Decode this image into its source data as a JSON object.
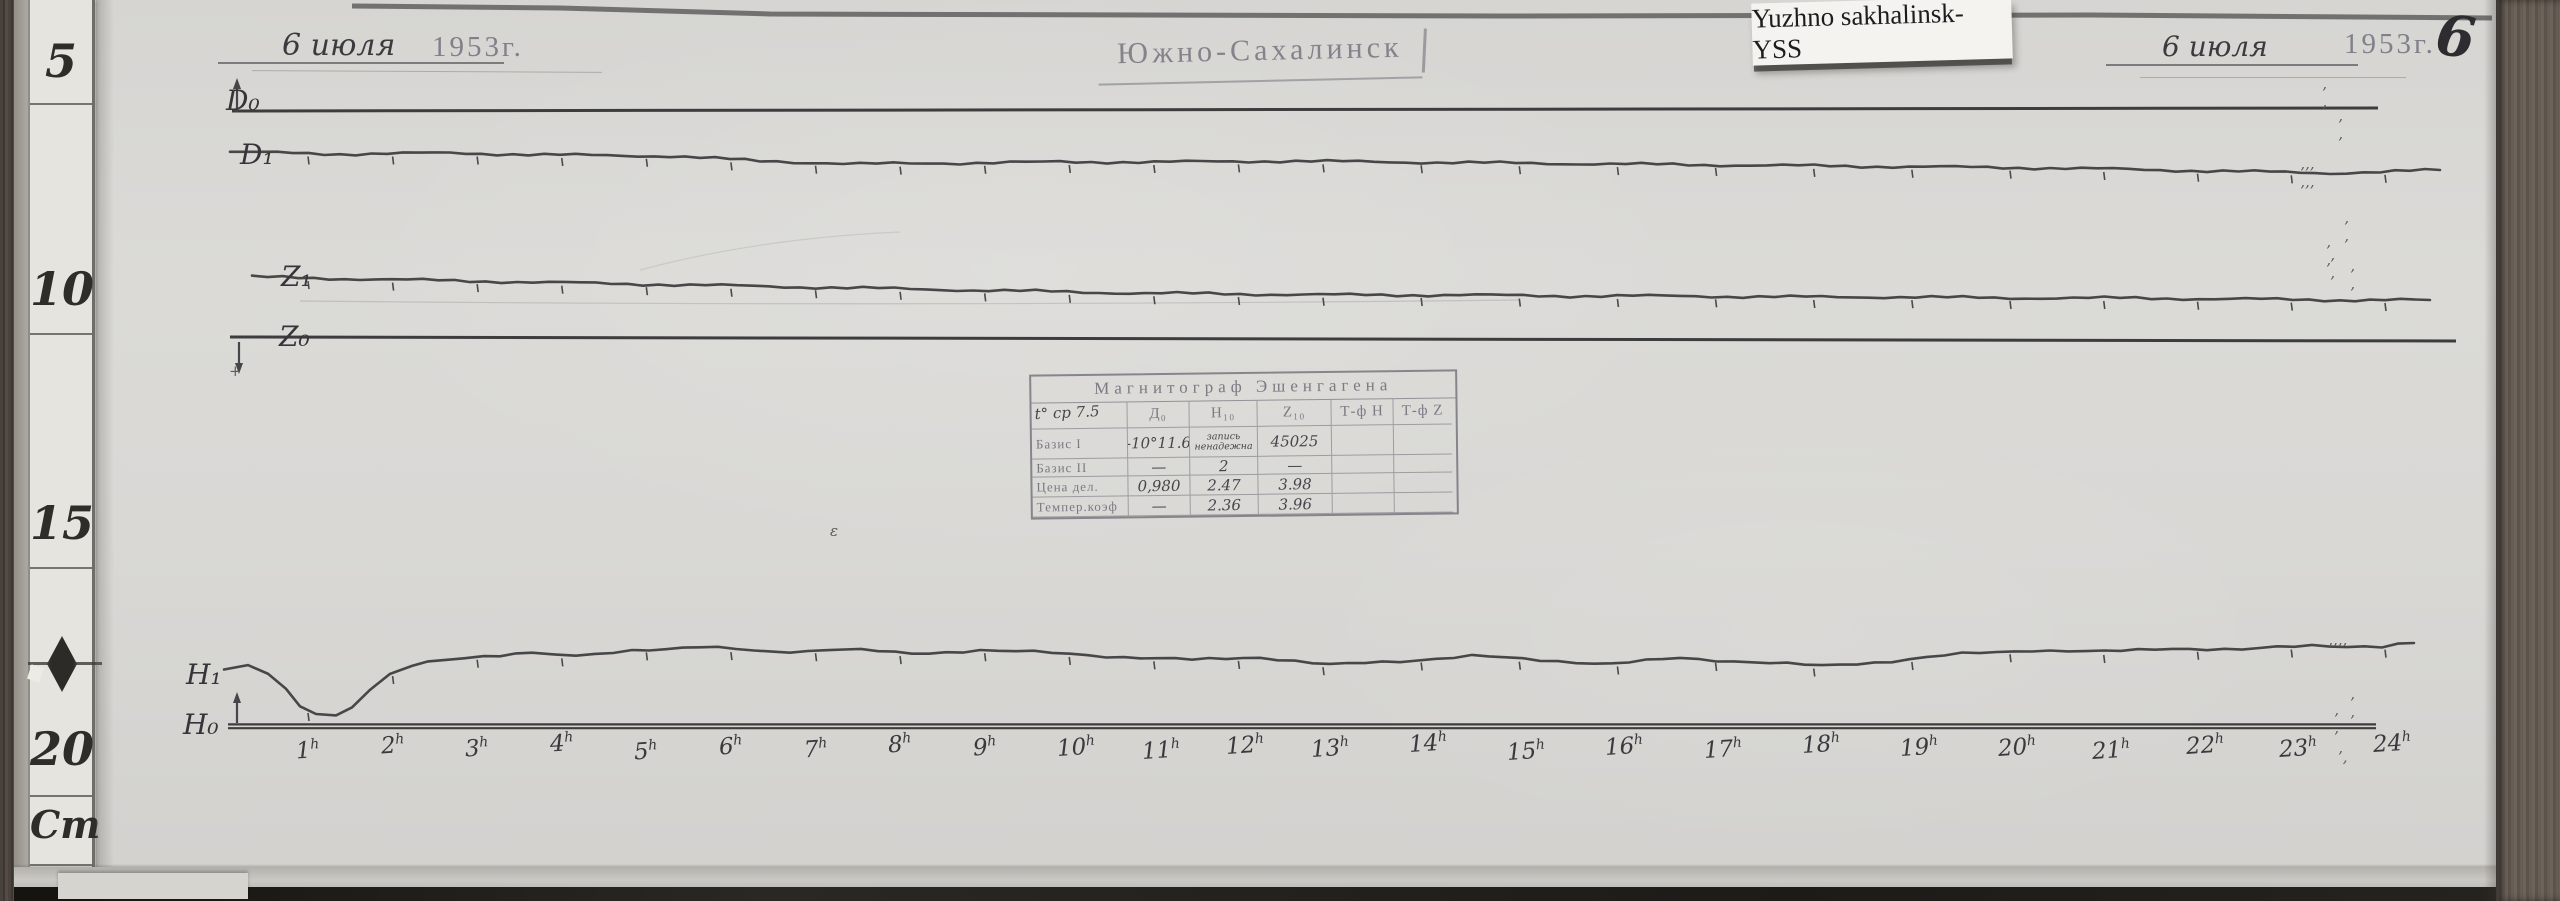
{
  "colors": {
    "trace_ink": "#474747",
    "baseline_ink": "#3d3d3d",
    "stamp_ink": "#74747c",
    "pencil": "#3a3a40",
    "paper": "#d9d8d5"
  },
  "scan": {
    "header_left": {
      "date": "6 июля",
      "year": "1953г."
    },
    "station_stamp": "Южно-Сахалинск",
    "archive_label": "Yuzhno sakhalinsk-YSS",
    "header_right": {
      "date": "6 июля",
      "year": "1953г.",
      "page_number": "6"
    },
    "ruler": {
      "marks": [
        "5",
        "10",
        "15",
        "20"
      ],
      "unit": "Cm"
    },
    "trace_labels": {
      "d0": "D₀",
      "d1": "D₁",
      "z1": "Z₁",
      "z0": "Z₀",
      "h1": "H₁",
      "h0": "H₀"
    },
    "hour_suffix": "h",
    "hours": [
      1,
      2,
      3,
      4,
      5,
      6,
      7,
      8,
      9,
      10,
      11,
      12,
      13,
      14,
      15,
      16,
      17,
      18,
      19,
      20,
      21,
      22,
      23,
      24
    ],
    "table": {
      "title": "Магнитограф Эшенгагена",
      "corner_note": "t° ср 7.5",
      "col_headers": [
        "Д₀",
        "Н₁₀",
        "Z₁₀",
        "Т-ф Н",
        "Т-ф Z"
      ],
      "rows": [
        {
          "label": "Базис I",
          "values": [
            "-10°11.6",
            "запись ненадежна",
            "45025",
            "",
            ""
          ]
        },
        {
          "label": "Базис II",
          "values": [
            "—",
            "2",
            "—",
            "",
            ""
          ]
        },
        {
          "label": "Цена дел.",
          "values": [
            "0,980",
            "2.47",
            "3.98",
            "",
            ""
          ]
        },
        {
          "label": "Темпер.коэф",
          "values": [
            "—",
            "2.36",
            "3.96",
            "",
            ""
          ]
        }
      ]
    },
    "pen_marks": [
      {
        "glyph": "’ ’",
        "x": 2322,
        "y": 84
      },
      {
        "glyph": "’ ’",
        "x": 2338,
        "y": 116
      },
      {
        "glyph": "’’’ ’’’",
        "x": 2300,
        "y": 164
      },
      {
        "glyph": "’ ’",
        "x": 2344,
        "y": 218
      },
      {
        "glyph": "’ ’",
        "x": 2326,
        "y": 242
      },
      {
        "glyph": "’ ’",
        "x": 2330,
        "y": 255
      },
      {
        "glyph": "’ ’",
        "x": 2350,
        "y": 266
      },
      {
        "glyph": "ε",
        "x": 830,
        "y": 522
      },
      {
        "glyph": "’’’’",
        "x": 2328,
        "y": 640
      },
      {
        "glyph": "’ ’",
        "x": 2350,
        "y": 694
      },
      {
        "glyph": "’ ’",
        "x": 2334,
        "y": 710
      },
      {
        "glyph": "’,",
        "x": 2338,
        "y": 748
      },
      {
        "glyph": "+",
        "x": 229,
        "y": 362
      }
    ]
  },
  "chart_data": {
    "type": "line",
    "title": "Магнитограф Эшенгагена — магнитограмма, Южно-Сахалинск, 6 июля 1953 г.",
    "xlabel": "время, часы (1h — 24h)",
    "ylabel": "сантиметры ленты (линейка: 5, 10, 15, 20 Cm)",
    "grid": false,
    "legend_position": "labels at left margin of each trace",
    "x_hours": [
      1,
      2,
      3,
      4,
      5,
      6,
      7,
      8,
      9,
      10,
      11,
      12,
      13,
      14,
      15,
      16,
      17,
      18,
      19,
      20,
      21,
      22,
      23,
      24
    ],
    "hour_axis_anchors_px": [
      [
        1,
        308
      ],
      [
        13,
        1323
      ],
      [
        20,
        2010
      ],
      [
        24,
        2385
      ]
    ],
    "series": [
      {
        "name": "D₀ базисная линия",
        "kind": "baseline",
        "ticks": false,
        "points_px": [
          [
            232,
            111
          ],
          [
            2378,
            108
          ]
        ]
      },
      {
        "name": "D₁ вариации склонения",
        "kind": "trace",
        "ticks": true,
        "points_px": [
          [
            230,
            152
          ],
          [
            340,
            154
          ],
          [
            450,
            153
          ],
          [
            560,
            155
          ],
          [
            670,
            156
          ],
          [
            760,
            161
          ],
          [
            860,
            164
          ],
          [
            960,
            163
          ],
          [
            1060,
            162
          ],
          [
            1170,
            162
          ],
          [
            1280,
            161
          ],
          [
            1390,
            162
          ],
          [
            1500,
            163
          ],
          [
            1610,
            164
          ],
          [
            1720,
            165
          ],
          [
            1830,
            166
          ],
          [
            1940,
            167
          ],
          [
            2050,
            168
          ],
          [
            2160,
            170
          ],
          [
            2270,
            172
          ],
          [
            2330,
            173
          ],
          [
            2380,
            172
          ],
          [
            2440,
            170
          ]
        ]
      },
      {
        "name": "Z₁ вариации вертикальной составляющей",
        "kind": "trace",
        "ticks": true,
        "points_px": [
          [
            252,
            277
          ],
          [
            360,
            279
          ],
          [
            470,
            281
          ],
          [
            580,
            283
          ],
          [
            690,
            285
          ],
          [
            800,
            287
          ],
          [
            910,
            289
          ],
          [
            1020,
            291
          ],
          [
            1130,
            293
          ],
          [
            1240,
            294
          ],
          [
            1350,
            295
          ],
          [
            1460,
            295
          ],
          [
            1570,
            296
          ],
          [
            1680,
            296
          ],
          [
            1790,
            297
          ],
          [
            1900,
            297
          ],
          [
            2010,
            298
          ],
          [
            2120,
            298
          ],
          [
            2230,
            299
          ],
          [
            2340,
            300
          ],
          [
            2430,
            300
          ]
        ]
      },
      {
        "name": "Z₀ базисная линия",
        "kind": "baseline",
        "ticks": false,
        "points_px": [
          [
            230,
            337
          ],
          [
            2456,
            341
          ]
        ]
      },
      {
        "name": "H₁ вариации горизонтальной составляющей (бухта около 1h)",
        "kind": "trace",
        "ticks": true,
        "points_px": [
          [
            224,
            670
          ],
          [
            248,
            666
          ],
          [
            268,
            674
          ],
          [
            286,
            690
          ],
          [
            300,
            706
          ],
          [
            316,
            714
          ],
          [
            336,
            715
          ],
          [
            352,
            706
          ],
          [
            370,
            690
          ],
          [
            390,
            674
          ],
          [
            412,
            666
          ],
          [
            444,
            660
          ],
          [
            484,
            656
          ],
          [
            532,
            652
          ],
          [
            576,
            657
          ],
          [
            632,
            650
          ],
          [
            700,
            647
          ],
          [
            772,
            652
          ],
          [
            844,
            649
          ],
          [
            912,
            654
          ],
          [
            980,
            650
          ],
          [
            1052,
            653
          ],
          [
            1124,
            657
          ],
          [
            1192,
            660
          ],
          [
            1260,
            657
          ],
          [
            1330,
            665
          ],
          [
            1400,
            661
          ],
          [
            1472,
            656
          ],
          [
            1540,
            660
          ],
          [
            1612,
            664
          ],
          [
            1680,
            658
          ],
          [
            1752,
            662
          ],
          [
            1822,
            666
          ],
          [
            1892,
            661
          ],
          [
            1962,
            654
          ],
          [
            2032,
            650
          ],
          [
            2104,
            652
          ],
          [
            2172,
            648
          ],
          [
            2242,
            650
          ],
          [
            2312,
            645
          ],
          [
            2382,
            647
          ],
          [
            2414,
            643
          ]
        ]
      },
      {
        "name": "H₀ базисная линия",
        "kind": "baseline",
        "ticks": false,
        "double_line": true,
        "points_px": [
          [
            228,
            726
          ],
          [
            2376,
            726
          ]
        ]
      }
    ]
  }
}
